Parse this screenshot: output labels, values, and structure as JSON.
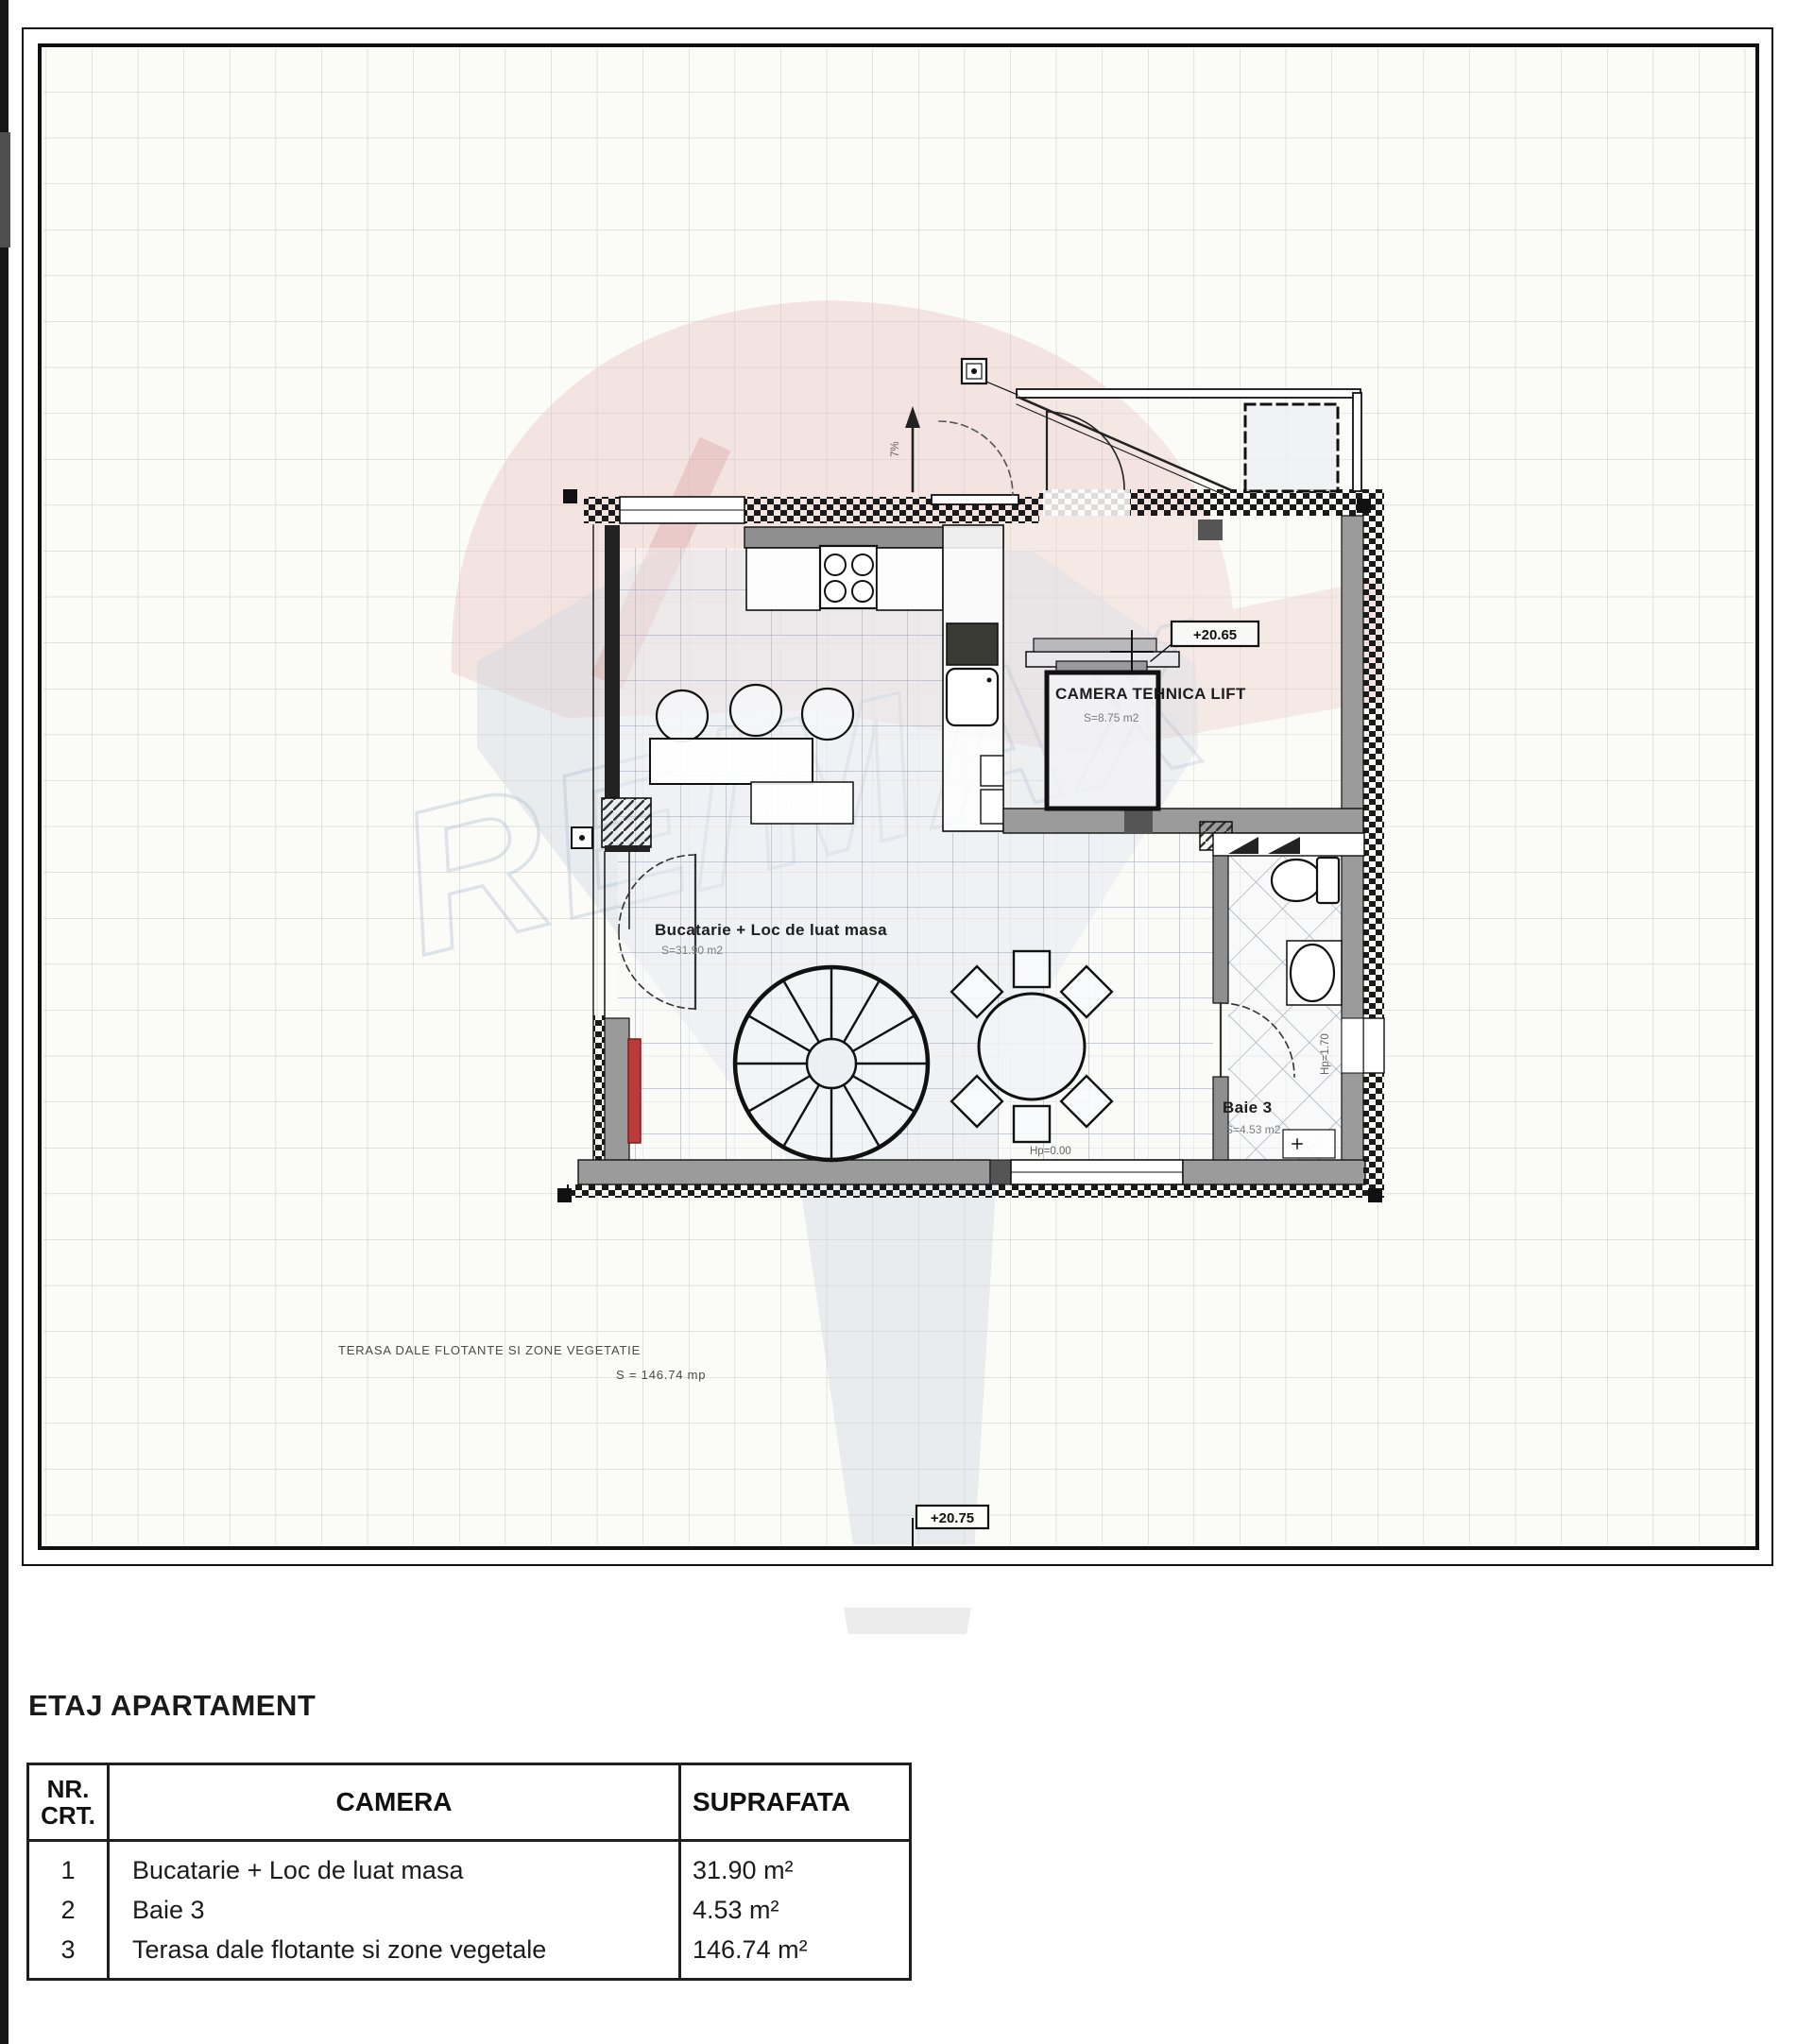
{
  "watermark": {
    "brand": "RE/MAX"
  },
  "plan": {
    "rooms": {
      "camera_tehnica": {
        "name": "CAMERA TEHNICA LIFT",
        "area": "S=8.75 m2"
      },
      "bucatarie": {
        "name": "Bucatarie + Loc de luat masa",
        "area": "S=31.90 m2"
      },
      "baie": {
        "name": "Baie 3",
        "area": "S=4.53 m2"
      },
      "terasa": {
        "name": "TERASA DALE FLOTANTE SI ZONE VEGETATIE",
        "area": "S = 146.74 mp"
      }
    },
    "markers": {
      "level_upper": "+20.65",
      "level_terrace": "+20.75",
      "hp_floor": "Hp=0.00",
      "hp_window": "Hp=1.70",
      "ramp_slope": "7%"
    }
  },
  "section": {
    "title": "ETAJ APARTAMENT"
  },
  "table": {
    "headers": {
      "nr": "NR.\nCRT.",
      "camera": "CAMERA",
      "suprafata": "SUPRAFATA"
    },
    "rows": [
      {
        "nr": "1",
        "camera": "Bucatarie + Loc de luat masa",
        "suprafata": "31.90 m²"
      },
      {
        "nr": "2",
        "camera": "Baie 3",
        "suprafata": "4.53 m²"
      },
      {
        "nr": "3",
        "camera": "Terasa dale flotante si zone vegetale",
        "suprafata": "146.74 m²"
      }
    ]
  }
}
